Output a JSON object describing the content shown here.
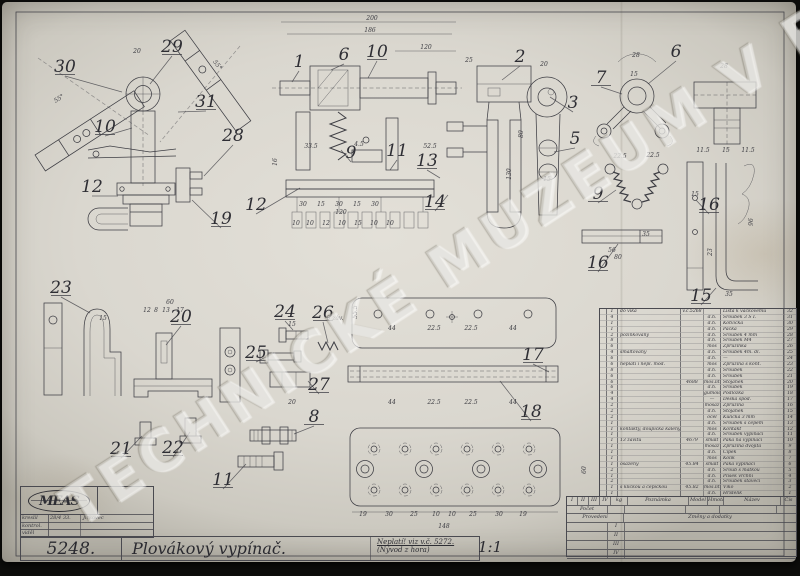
{
  "watermark": {
    "text": "TECHNICKÉ MUZEUM V BRNĚ"
  },
  "title_block": {
    "logo": "MEAS",
    "sign_rows": [
      {
        "label": "kreslil",
        "date": "28/4 33.",
        "signature": "Jirkovec"
      },
      {
        "label": "kontrol.",
        "date": "",
        "signature": ""
      },
      {
        "label": "viděl",
        "date": "",
        "signature": ""
      }
    ],
    "drawing_number": "5248.",
    "title": "Plovákový vypínač.",
    "note_line1": "Neplatí! viz v.č. 5272.",
    "note_line2": "(Nývod z hora)",
    "scale": "1:1"
  },
  "parts_table": {
    "rows": [
      {
        "q": "1",
        "note": "do víka",
        "model": "v.č.5268",
        "mat": "",
        "name": "Lišta k vačkovému",
        "no": "32"
      },
      {
        "q": "4",
        "note": "",
        "model": "",
        "mat": "d.h.",
        "name": "Šroubek 3 Š I.",
        "no": "31"
      },
      {
        "q": "1",
        "note": "",
        "model": "",
        "mat": "d.h.",
        "name": "Kotvička",
        "no": "30"
      },
      {
        "q": "1",
        "note": "",
        "model": "",
        "mat": "d.h.",
        "name": "Páčka",
        "no": "29"
      },
      {
        "q": "2",
        "note": "pozinkovaný",
        "model": "",
        "mat": "d.h.",
        "name": "Šroubek 4 mm",
        "no": "28"
      },
      {
        "q": "8",
        "note": "",
        "model": "",
        "mat": "d.h.",
        "name": "Šroubek M4",
        "no": "27"
      },
      {
        "q": "6",
        "note": "",
        "model": "",
        "mat": "mos",
        "name": "Zpružinka",
        "no": "26"
      },
      {
        "q": "4",
        "note": "smaltovaný",
        "model": "",
        "mat": "d.h.",
        "name": "Šroubek 4m. dl.",
        "no": "25"
      },
      {
        "q": "6",
        "note": "",
        "model": "",
        "mat": "d.h.",
        "name": "—",
        "no": "24"
      },
      {
        "q": "6",
        "note": "neplatí i nepl. mod.",
        "model": "",
        "mat": "mos",
        "name": "Zpružina s kont.",
        "no": "23"
      },
      {
        "q": "8",
        "note": "",
        "model": "",
        "mat": "d.h.",
        "name": "Šroubek",
        "no": "22"
      },
      {
        "q": "6",
        "note": "",
        "model": "",
        "mat": "d.h.",
        "name": "Šroubek",
        "no": "21"
      },
      {
        "q": "6",
        "note": "",
        "model": "4688",
        "mat": "mos.lit.",
        "name": "Stojánek",
        "no": "20"
      },
      {
        "q": "6",
        "note": "",
        "model": "",
        "mat": "d.h.",
        "name": "Šroubek",
        "no": "19"
      },
      {
        "q": "4",
        "note": "",
        "model": "",
        "mat": "gumoid",
        "name": "Podložka",
        "no": "18"
      },
      {
        "q": "4",
        "note": "",
        "model": "",
        "mat": "—",
        "name": "Deska spod.",
        "no": "17"
      },
      {
        "q": "2",
        "note": "",
        "model": "",
        "mat": "mosaz",
        "name": "Zpružina",
        "no": "16"
      },
      {
        "q": "2",
        "note": "",
        "model": "",
        "mat": "d.h.",
        "name": "Stojánek",
        "no": "15"
      },
      {
        "q": "2",
        "note": "",
        "model": "",
        "mat": "ocel",
        "name": "Kulička 3 mm",
        "no": "14"
      },
      {
        "q": "1",
        "note": "",
        "model": "",
        "mat": "d.h.",
        "name": "Šroubek s čepem",
        "no": "13"
      },
      {
        "q": "1",
        "note": "kontakty, doupíčka kalený",
        "model": "",
        "mat": "mos",
        "name": "Kontakt",
        "no": "12"
      },
      {
        "q": "1",
        "note": "",
        "model": "",
        "mat": "d.h.",
        "name": "Šroubek vypínací",
        "no": "11"
      },
      {
        "q": "1",
        "note": "13 závitů",
        "model": "4679",
        "mat": "smalt",
        "name": "Páka na vypínací",
        "no": "10"
      },
      {
        "q": "1",
        "note": "",
        "model": "",
        "mat": "mosaz",
        "name": "Zpružina dvojitá",
        "no": "9"
      },
      {
        "q": "1",
        "note": "",
        "model": "",
        "mat": "d.h.",
        "name": "Čípek",
        "no": "8"
      },
      {
        "q": "1",
        "note": "",
        "model": "",
        "mat": "mos",
        "name": "Kolík",
        "no": "7"
      },
      {
        "q": "1",
        "note": "osazený",
        "model": "45.84",
        "mat": "smalt",
        "name": "Páka vypínací",
        "no": "6"
      },
      {
        "q": "2",
        "note": "",
        "model": "",
        "mat": "d.h.",
        "name": "Šroub s matkou",
        "no": "5"
      },
      {
        "q": "1",
        "note": "",
        "model": "",
        "mat": "d.h.",
        "name": "Plíšek vrchní",
        "no": "4"
      },
      {
        "q": "2",
        "note": "",
        "model": "",
        "mat": "d.h.",
        "name": "Šroubek stavěcí",
        "no": "3"
      },
      {
        "q": "1",
        "note": "s kličkou a čepičkou",
        "model": "45.82",
        "mat": "mos.lit.",
        "name": "Víko",
        "no": "2"
      },
      {
        "q": "1",
        "note": "",
        "model": "",
        "mat": "d.h.",
        "name": "Hřídelík",
        "no": "1"
      }
    ]
  },
  "footer": {
    "provedeni_cols": [
      "I",
      "II",
      "III",
      "IV"
    ],
    "headers": {
      "pocet": "Počet",
      "kg": "kg",
      "poznamka": "Poznámka",
      "model": "Model",
      "hmota": "Hmota",
      "nazev": "Název",
      "cis": "Čís"
    },
    "provedeni_label": "Provedení",
    "zmeny_label": "Změny a dodatky",
    "revision_rows": [
      "I",
      "II",
      "III",
      "IV"
    ]
  },
  "drawing": {
    "callouts": [
      {
        "t": "30",
        "x": 65,
        "y": 72,
        "u": 1,
        "tx": 122,
        "ty": 92
      },
      {
        "t": "29",
        "x": 172,
        "y": 52,
        "u": 1,
        "tx": 150,
        "ty": 84
      },
      {
        "t": "31",
        "x": 206,
        "y": 107,
        "u": 1,
        "tx": 178,
        "ty": 112
      },
      {
        "t": "10",
        "x": 105,
        "y": 132,
        "u": 1,
        "tx": 132,
        "ty": 128
      },
      {
        "t": "28",
        "x": 233,
        "y": 141,
        "u": 0,
        "tx": 204,
        "ty": 176
      },
      {
        "t": "12",
        "x": 92,
        "y": 192,
        "u": 0,
        "tx": 118,
        "ty": 196
      },
      {
        "t": "19",
        "x": 221,
        "y": 224,
        "u": 1,
        "tx": 192,
        "ty": 200
      },
      {
        "t": "12",
        "x": 256,
        "y": 210,
        "u": 0,
        "tx": 300,
        "ty": 188
      },
      {
        "t": "1",
        "x": 299,
        "y": 67,
        "u": 0,
        "tx": 292,
        "ty": 82
      },
      {
        "t": "6",
        "x": 344,
        "y": 60,
        "u": 0,
        "tx": 331,
        "ty": 70
      },
      {
        "t": "10",
        "x": 377,
        "y": 57,
        "u": 1,
        "tx": 368,
        "ty": 78
      },
      {
        "t": "9",
        "x": 351,
        "y": 158,
        "u": 0,
        "tx": 341,
        "ty": 150
      },
      {
        "t": "11",
        "x": 397,
        "y": 156,
        "u": 0,
        "tx": 390,
        "ty": 170
      },
      {
        "t": "13",
        "x": 427,
        "y": 166,
        "u": 1,
        "tx": 440,
        "ty": 178
      },
      {
        "t": "14",
        "x": 435,
        "y": 207,
        "u": 1,
        "tx": 448,
        "ty": 195
      },
      {
        "t": "2",
        "x": 520,
        "y": 62,
        "u": 0,
        "tx": 502,
        "ty": 80
      },
      {
        "t": "3",
        "x": 573,
        "y": 108,
        "u": 0,
        "tx": 550,
        "ty": 97
      },
      {
        "t": "5",
        "x": 575,
        "y": 144,
        "u": 0,
        "tx": 554,
        "ty": 152
      },
      {
        "t": "7",
        "x": 601,
        "y": 83,
        "u": 1,
        "tx": 622,
        "ty": 94
      },
      {
        "t": "6",
        "x": 676,
        "y": 57,
        "u": 0,
        "tx": 648,
        "ty": 84
      },
      {
        "t": "9",
        "x": 598,
        "y": 199,
        "u": 1,
        "tx": 616,
        "ty": 190
      },
      {
        "t": "16",
        "x": 598,
        "y": 268,
        "u": 1,
        "tx": 618,
        "ty": 244
      },
      {
        "t": "16",
        "x": 709,
        "y": 210,
        "u": 1,
        "tx": 696,
        "ty": 200
      },
      {
        "t": "15",
        "x": 701,
        "y": 301,
        "u": 1,
        "tx": 716,
        "ty": 288
      },
      {
        "t": "23",
        "x": 61,
        "y": 293,
        "u": 1,
        "tx": 90,
        "ty": 313
      },
      {
        "t": "20",
        "x": 181,
        "y": 322,
        "u": 1,
        "tx": 166,
        "ty": 345
      },
      {
        "t": "21",
        "x": 121,
        "y": 454,
        "u": 1,
        "tx": 142,
        "ty": 436
      },
      {
        "t": "22",
        "x": 173,
        "y": 453,
        "u": 1,
        "tx": 190,
        "ty": 432
      },
      {
        "t": "11",
        "x": 223,
        "y": 485,
        "u": 1,
        "tx": 246,
        "ty": 464
      },
      {
        "t": "24",
        "x": 285,
        "y": 317,
        "u": 1,
        "tx": 293,
        "ty": 330
      },
      {
        "t": "26",
        "x": 323,
        "y": 318,
        "u": 1,
        "tx": 328,
        "ty": 343
      },
      {
        "t": "25",
        "x": 256,
        "y": 358,
        "u": 1,
        "tx": 266,
        "ty": 357
      },
      {
        "t": "27",
        "x": 319,
        "y": 390,
        "u": 1,
        "tx": 308,
        "ty": 381
      },
      {
        "t": "8",
        "x": 314,
        "y": 422,
        "u": 1,
        "tx": 294,
        "ty": 434
      },
      {
        "t": "17",
        "x": 533,
        "y": 360,
        "u": 1,
        "tx": 549,
        "ty": 372
      },
      {
        "t": "18",
        "x": 531,
        "y": 417,
        "u": 1,
        "tx": 500,
        "ty": 381
      }
    ],
    "dims": [
      {
        "t": "200",
        "x": 372,
        "y": 20
      },
      {
        "t": "186",
        "x": 370,
        "y": 32
      },
      {
        "t": "120",
        "x": 426,
        "y": 49
      },
      {
        "t": "20",
        "x": 137,
        "y": 53
      },
      {
        "t": "55°",
        "x": 60,
        "y": 100,
        "r": -33
      },
      {
        "t": "55°",
        "x": 216,
        "y": 66,
        "r": 52
      },
      {
        "t": "33.5",
        "x": 311,
        "y": 148
      },
      {
        "t": "4.5",
        "x": 359,
        "y": 146
      },
      {
        "t": "52.5",
        "x": 430,
        "y": 148
      },
      {
        "t": "16",
        "x": 277,
        "y": 162,
        "r": -90
      },
      {
        "t": "30",
        "x": 303,
        "y": 206
      },
      {
        "t": "15",
        "x": 321,
        "y": 206
      },
      {
        "t": "30",
        "x": 339,
        "y": 206
      },
      {
        "t": "15",
        "x": 357,
        "y": 206
      },
      {
        "t": "30",
        "x": 375,
        "y": 206
      },
      {
        "t": "120",
        "x": 341,
        "y": 214
      },
      {
        "t": "10",
        "x": 296,
        "y": 225
      },
      {
        "t": "10",
        "x": 310,
        "y": 225
      },
      {
        "t": "12",
        "x": 326,
        "y": 225
      },
      {
        "t": "10",
        "x": 342,
        "y": 225
      },
      {
        "t": "15",
        "x": 358,
        "y": 225
      },
      {
        "t": "10",
        "x": 374,
        "y": 225
      },
      {
        "t": "10",
        "x": 390,
        "y": 225
      },
      {
        "t": "25",
        "x": 469,
        "y": 62
      },
      {
        "t": "20",
        "x": 544,
        "y": 66
      },
      {
        "t": "80",
        "x": 523,
        "y": 134,
        "r": -90
      },
      {
        "t": "130",
        "x": 511,
        "y": 174,
        "r": -90
      },
      {
        "t": "15",
        "x": 547,
        "y": 181
      },
      {
        "t": "28",
        "x": 636,
        "y": 57
      },
      {
        "t": "15",
        "x": 634,
        "y": 76
      },
      {
        "t": "28",
        "x": 724,
        "y": 68
      },
      {
        "t": "11.5",
        "x": 703,
        "y": 152
      },
      {
        "t": "15",
        "x": 726,
        "y": 152
      },
      {
        "t": "11.5",
        "x": 748,
        "y": 152
      },
      {
        "t": "22.5",
        "x": 620,
        "y": 158
      },
      {
        "t": "22.5",
        "x": 653,
        "y": 157
      },
      {
        "t": "35",
        "x": 646,
        "y": 236
      },
      {
        "t": "56",
        "x": 612,
        "y": 252
      },
      {
        "t": "80",
        "x": 618,
        "y": 259
      },
      {
        "t": "15",
        "x": 695,
        "y": 196
      },
      {
        "t": "23",
        "x": 712,
        "y": 252,
        "r": -90
      },
      {
        "t": "96",
        "x": 753,
        "y": 222,
        "r": -90
      },
      {
        "t": "35",
        "x": 729,
        "y": 296
      },
      {
        "t": "60",
        "x": 170,
        "y": 304
      },
      {
        "t": "12",
        "x": 147,
        "y": 312
      },
      {
        "t": "8",
        "x": 156,
        "y": 312
      },
      {
        "t": "13",
        "x": 166,
        "y": 312
      },
      {
        "t": "17",
        "x": 180,
        "y": 312
      },
      {
        "t": "15",
        "x": 103,
        "y": 320
      },
      {
        "t": "55.5",
        "x": 357,
        "y": 312,
        "r": -90
      },
      {
        "t": "44",
        "x": 392,
        "y": 330
      },
      {
        "t": "22.5",
        "x": 434,
        "y": 330
      },
      {
        "t": "22.5",
        "x": 471,
        "y": 330
      },
      {
        "t": "44",
        "x": 513,
        "y": 330
      },
      {
        "t": "44",
        "x": 392,
        "y": 404
      },
      {
        "t": "22.5",
        "x": 434,
        "y": 404
      },
      {
        "t": "22.5",
        "x": 471,
        "y": 404
      },
      {
        "t": "44",
        "x": 513,
        "y": 404
      },
      {
        "t": "19",
        "x": 363,
        "y": 516
      },
      {
        "t": "30",
        "x": 389,
        "y": 516
      },
      {
        "t": "25",
        "x": 414,
        "y": 516
      },
      {
        "t": "10",
        "x": 436,
        "y": 516
      },
      {
        "t": "10",
        "x": 452,
        "y": 516
      },
      {
        "t": "25",
        "x": 473,
        "y": 516
      },
      {
        "t": "30",
        "x": 499,
        "y": 516
      },
      {
        "t": "19",
        "x": 523,
        "y": 516
      },
      {
        "t": "148",
        "x": 444,
        "y": 528
      },
      {
        "t": "60",
        "x": 586,
        "y": 470,
        "r": -90
      },
      {
        "t": "15",
        "x": 292,
        "y": 326
      },
      {
        "t": "6 záv.",
        "x": 335,
        "y": 320
      },
      {
        "t": "20",
        "x": 292,
        "y": 404
      }
    ]
  }
}
